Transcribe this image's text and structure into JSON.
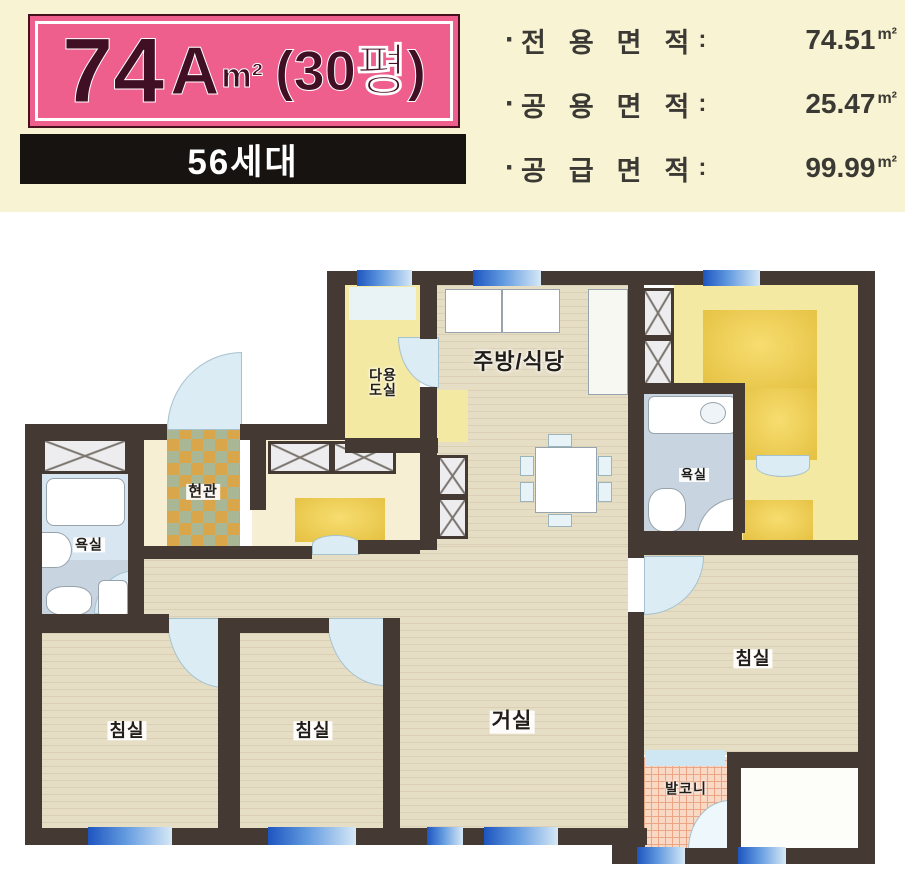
{
  "header": {
    "badge": {
      "size": "74",
      "type": "A",
      "unit": "m²",
      "pyeong": "(30평)"
    },
    "households": "56세대",
    "areas": [
      {
        "bullet": "·",
        "label": "전용면적",
        "colon": ":",
        "value": "74.51",
        "unit": "m²"
      },
      {
        "bullet": "·",
        "label": "공용면적",
        "colon": ":",
        "value": "25.47",
        "unit": "m²"
      },
      {
        "bullet": "·",
        "label": "공급면적",
        "colon": ":",
        "value": "99.99",
        "unit": "m²"
      }
    ]
  },
  "plan": {
    "rooms": {
      "utility": "다용도실",
      "kitchen": "주방/식당",
      "entrance": "현관",
      "bath_left": "욕실",
      "bath_right": "욕실",
      "bedroom_left": "침실",
      "bedroom_middle": "침실",
      "bedroom_right": "침실",
      "living": "거실",
      "balcony": "발코니"
    }
  },
  "colors": {
    "header-bg": "#f8f3d2",
    "badge-pink": "#ee5f8e",
    "badge-text": "#400f24",
    "banner-bg": "#161310",
    "ink": "#3b3934",
    "wall": "#443a33",
    "tan": "#e6ddc5",
    "yellow": "#f4e9a2",
    "gold": "#e9c84e",
    "cream": "#f6efd3",
    "arc": "#dcecf5",
    "bath": "#c9d4e1",
    "tile-a": "#d9a64c",
    "tile-b": "#a9b795",
    "balcony": "#f9d9c4",
    "win-deep": "#1d55c0"
  }
}
